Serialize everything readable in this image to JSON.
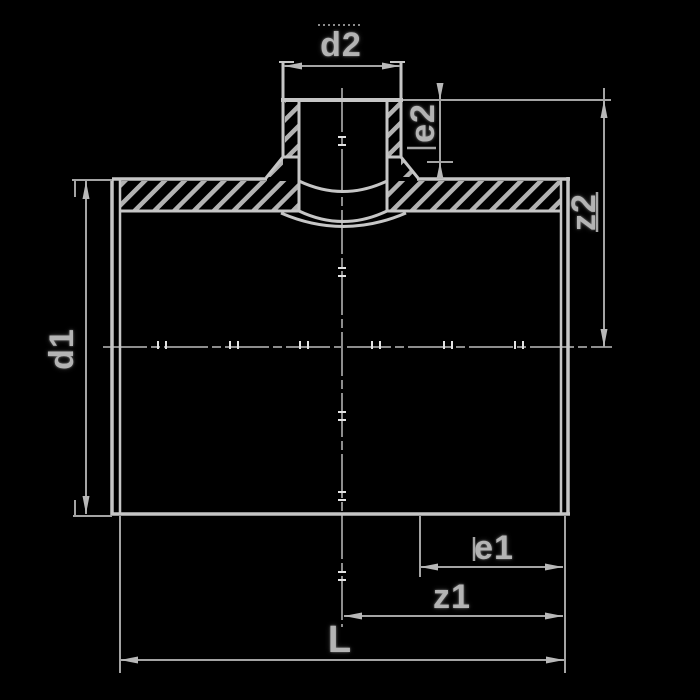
{
  "figure": {
    "background_color": "#000000",
    "contour_line_color": "#c6c6c6",
    "dimension_line_color": "#a4a4a4",
    "hatch_color": "#b2b2b2",
    "centerline_color": "#8d8d8d",
    "label_text_color": "#b4b4b4"
  },
  "dimension_labels": {
    "d2": "d2",
    "e2": "e2",
    "z2": "z2",
    "d1": "d1",
    "e1": "e1",
    "z1": "z1",
    "L": "L"
  }
}
